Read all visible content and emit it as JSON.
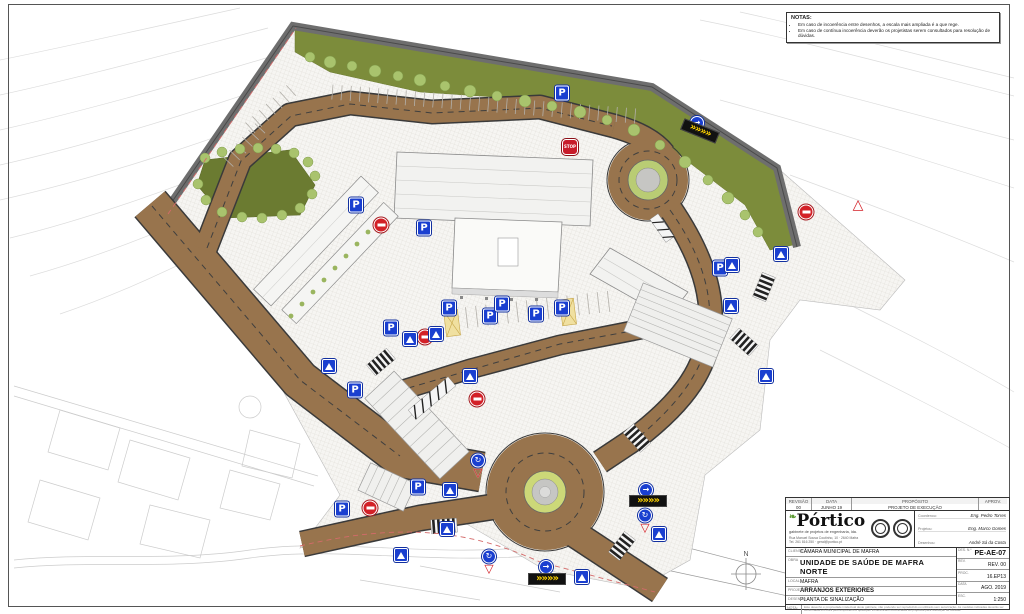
{
  "sheet": {
    "north_label": "N",
    "notes_box": {
      "title": "NOTAS:",
      "items": [
        "Em caso de incoerência entre desenhos, a escala mais ampliada é a que rege.",
        "Em caso de contínua incoerência deverão os projetistas serem consultados para resolução de dúvidas."
      ]
    }
  },
  "title_block": {
    "revision": {
      "headers": [
        "REVISÃO",
        "DATA",
        "PROPÓSITO",
        "APROV."
      ],
      "row": [
        "00",
        "JUNHO 19",
        "PROJETO DE EXECUÇÃO",
        ""
      ]
    },
    "company": {
      "name": "órtico",
      "initial": "P",
      "leaf": "❧",
      "tagline": "gabinete de projetos de engenharia, lda.",
      "addr1": "Rua Manuel Sousa Coutinho, 10 · 2640 Mafra",
      "addr2": "Tel. 261 816 250 · geral@portico.pt"
    },
    "team": [
      {
        "label": "Coordenou:",
        "value": "Eng. Pedro Torres"
      },
      {
        "label": "Projetou:",
        "value": "Eng. Marco Gomes"
      },
      {
        "label": "Desenhou:",
        "value": "André Sá da Costa"
      }
    ],
    "fields": [
      {
        "label": "CLIENTE",
        "value": "CÂMARA MUNICIPAL DE MAFRA"
      },
      {
        "label": "OBRA",
        "value": "UNIDADE DE SAÚDE DE MAFRA NORTE"
      },
      {
        "label": "LOCAL",
        "value": "MAFRA"
      },
      {
        "label": "PROJETO",
        "value": "ARRANJOS EXTERIORES"
      },
      {
        "label": "DESENHO",
        "value": "PLANTA DE SINALIZAÇÃO"
      }
    ],
    "meta": [
      {
        "label": "DES. N.º",
        "value": "PE-AE-07"
      },
      {
        "label": "REV.",
        "value": "REV. 00"
      },
      {
        "label": "PROC.",
        "value": "16.EP13"
      },
      {
        "label": "DATA",
        "value": "AGO. 2019"
      },
      {
        "label": "ESC.",
        "value": "1:250"
      }
    ],
    "footnote": {
      "label": "NOTA:",
      "text": "Este desenho é propriedade intelectual deste gabinete, não podendo ser reproduzido ou utilizado sem autorização. As medidas indicadas deverão ser confirmadas em obra pelo empreiteiro e quaisquer incoerências comunicadas ao projetista para resolução de dúvidas."
    }
  },
  "plan": {
    "colors": {
      "road": "#98744d",
      "sign_blue": "#1a3fd0",
      "sign_red": "#d32027",
      "chevron_yellow": "#ffd400",
      "lawn": "#6b7b31",
      "bush": "#a9c36d",
      "wall": "#6e6e6e",
      "island_ring": "#ccd878"
    },
    "sign_glyphs": {
      "parking": "P",
      "stop": "STOP",
      "arrow": "→",
      "chevron": "»»»»",
      "warning": "△",
      "giveway_circ": "↻",
      "yield": "▽"
    },
    "signs": [
      {
        "t": "parking",
        "x": 356,
        "y": 205
      },
      {
        "t": "parking",
        "x": 424,
        "y": 228
      },
      {
        "t": "parking",
        "x": 562,
        "y": 93
      },
      {
        "t": "parking",
        "x": 449,
        "y": 308
      },
      {
        "t": "parking",
        "x": 490,
        "y": 316
      },
      {
        "t": "parking",
        "x": 502,
        "y": 304
      },
      {
        "t": "parking",
        "x": 536,
        "y": 314
      },
      {
        "t": "parking",
        "x": 562,
        "y": 308
      },
      {
        "t": "parking",
        "x": 391,
        "y": 328
      },
      {
        "t": "parking",
        "x": 355,
        "y": 390
      },
      {
        "t": "parking",
        "x": 342,
        "y": 509
      },
      {
        "t": "parking",
        "x": 418,
        "y": 487
      },
      {
        "t": "parking",
        "x": 720,
        "y": 268
      },
      {
        "t": "no-entry",
        "x": 381,
        "y": 225
      },
      {
        "t": "no-entry",
        "x": 425,
        "y": 337
      },
      {
        "t": "no-entry",
        "x": 477,
        "y": 399
      },
      {
        "t": "no-entry",
        "x": 370,
        "y": 508
      },
      {
        "t": "no-entry",
        "x": 806,
        "y": 212
      },
      {
        "t": "stop",
        "x": 570,
        "y": 147
      },
      {
        "t": "cross",
        "x": 329,
        "y": 366
      },
      {
        "t": "cross",
        "x": 410,
        "y": 339
      },
      {
        "t": "cross",
        "x": 436,
        "y": 334
      },
      {
        "t": "cross",
        "x": 470,
        "y": 376
      },
      {
        "t": "cross",
        "x": 732,
        "y": 265
      },
      {
        "t": "cross",
        "x": 731,
        "y": 306
      },
      {
        "t": "cross",
        "x": 766,
        "y": 376
      },
      {
        "t": "cross",
        "x": 781,
        "y": 254
      },
      {
        "t": "cross",
        "x": 447,
        "y": 529
      },
      {
        "t": "cross",
        "x": 401,
        "y": 555
      },
      {
        "t": "cross",
        "x": 450,
        "y": 490
      },
      {
        "t": "cross",
        "x": 582,
        "y": 577
      },
      {
        "t": "cross",
        "x": 659,
        "y": 534
      },
      {
        "t": "giveway",
        "x": 478,
        "y": 466
      },
      {
        "t": "giveway",
        "x": 645,
        "y": 521
      },
      {
        "t": "giveway",
        "x": 489,
        "y": 562
      },
      {
        "t": "arrow",
        "x": 646,
        "y": 490
      },
      {
        "t": "arrow",
        "x": 546,
        "y": 567
      },
      {
        "t": "arrow",
        "x": 697,
        "y": 123
      },
      {
        "t": "chevron",
        "x": 700,
        "y": 131,
        "r": 22
      },
      {
        "t": "chevron",
        "x": 648,
        "y": 501
      },
      {
        "t": "chevron",
        "x": 547,
        "y": 579
      },
      {
        "t": "warning",
        "x": 858,
        "y": 205
      }
    ]
  }
}
